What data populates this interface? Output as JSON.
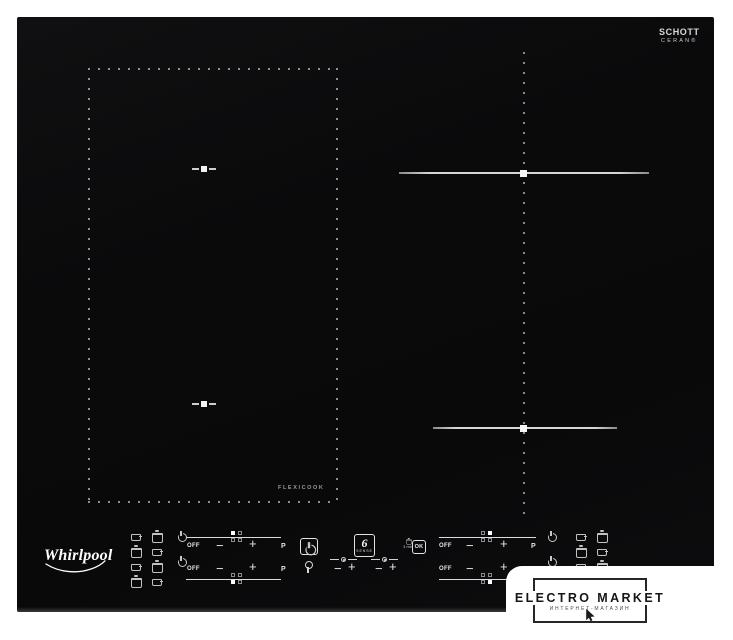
{
  "cooktop": {
    "brand": "Whirlpool",
    "glass_brand": {
      "line1": "SCHOTT",
      "line2": "CERAN®"
    },
    "flexicook_label": "FLEXICOOK"
  },
  "controls": {
    "off": "OFF",
    "minus": "−",
    "plus": "+",
    "boost": "P",
    "ok": "OK",
    "timer_hint": "3 min",
    "sense_number": "6",
    "sense_word": "SENSE"
  },
  "icons": {
    "standby": "power-circle-with-bar",
    "lock": "key",
    "cookware": "pot-and-pan-size-glyphs",
    "flexicook_marker": "dash-square-dash",
    "pointer": "mouse-cursor-arrow"
  },
  "colors": {
    "glass_black": "#0a0a0c",
    "marking_white": "#e8e8e8",
    "dotted_gray": "#8f8f8f",
    "watermark_ink": "#1a1a1a",
    "background": "#ffffff"
  },
  "watermark": {
    "title": "ELECTRO MARKET",
    "subtitle": "ИНТЕРНЕТ-МАГАЗИН"
  }
}
